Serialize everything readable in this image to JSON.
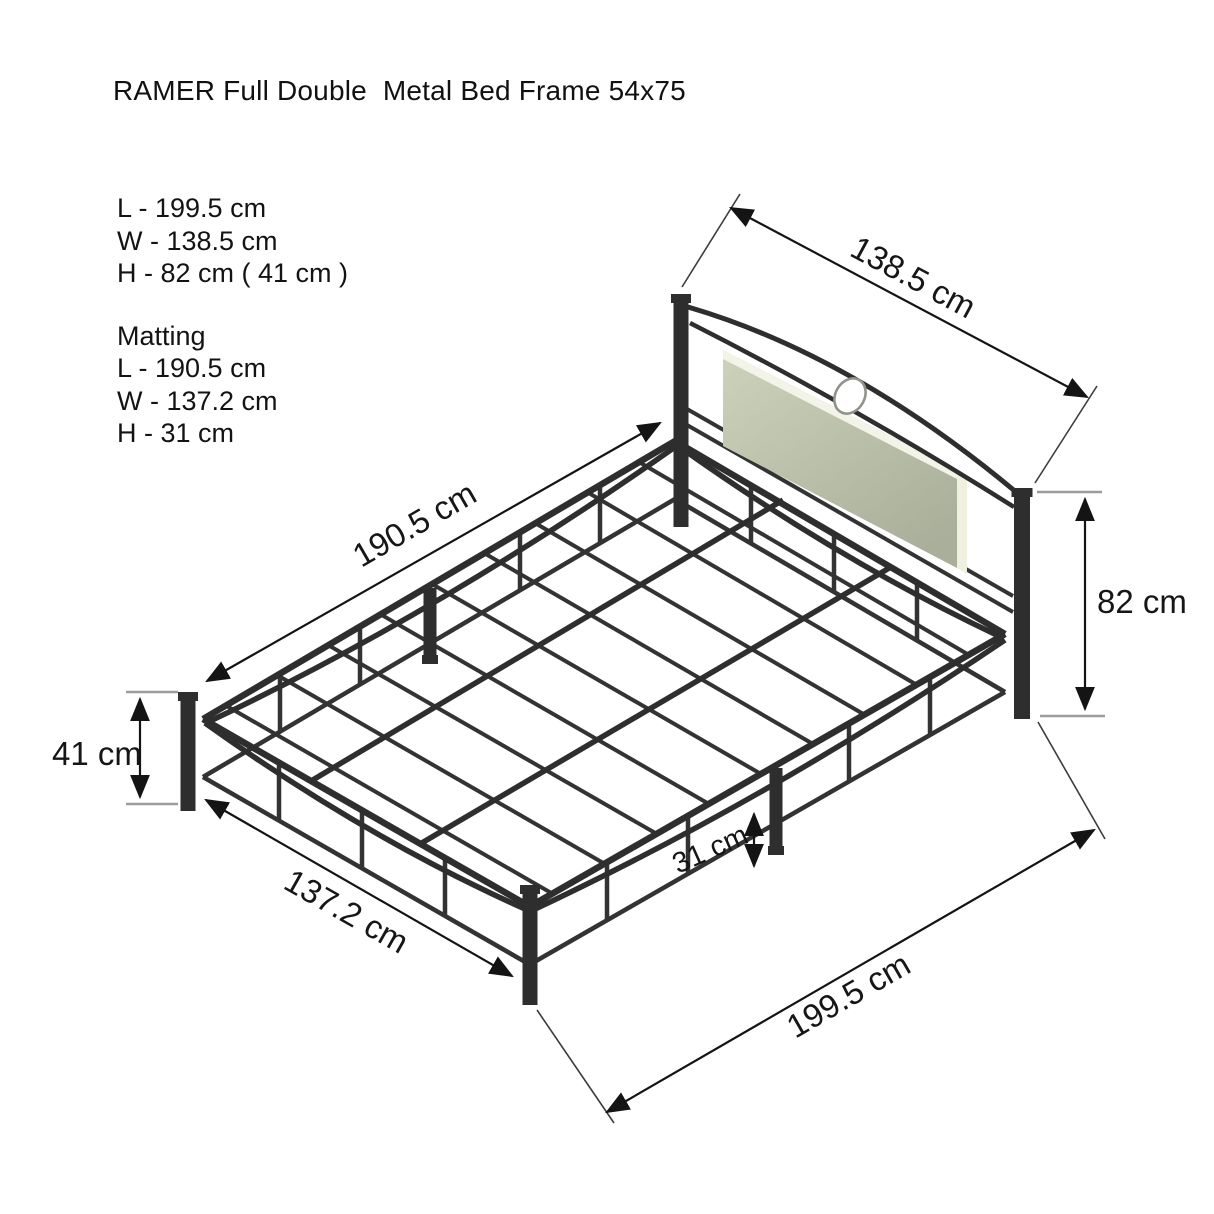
{
  "title": "RAMER Full Double  Metal Bed Frame 54x75",
  "specs": {
    "overall": {
      "length": "L - 199.5 cm",
      "width": "W - 138.5 cm",
      "height": "H - 82 cm ( 41 cm )"
    },
    "matting_heading": "Matting",
    "matting": {
      "length": "L - 190.5 cm",
      "width": "W - 137.2 cm",
      "height": "H - 31 cm"
    }
  },
  "diagram": {
    "labels": {
      "headboard_width": "138.5 cm",
      "matting_length": "190.5 cm",
      "overall_height": "82 cm",
      "base_height": "41 cm",
      "matting_width": "137.2 cm",
      "clearance_height": "31 cm",
      "overall_length": "199.5 cm"
    },
    "colors": {
      "frame": "#2e2e2e",
      "panel_highlight": "#f3f4e7",
      "panel_face_light": "#cdd2bc",
      "panel_face_dark": "#abb19c",
      "dimension_line": "#141414",
      "tick_line": "#9b9b9b"
    }
  }
}
